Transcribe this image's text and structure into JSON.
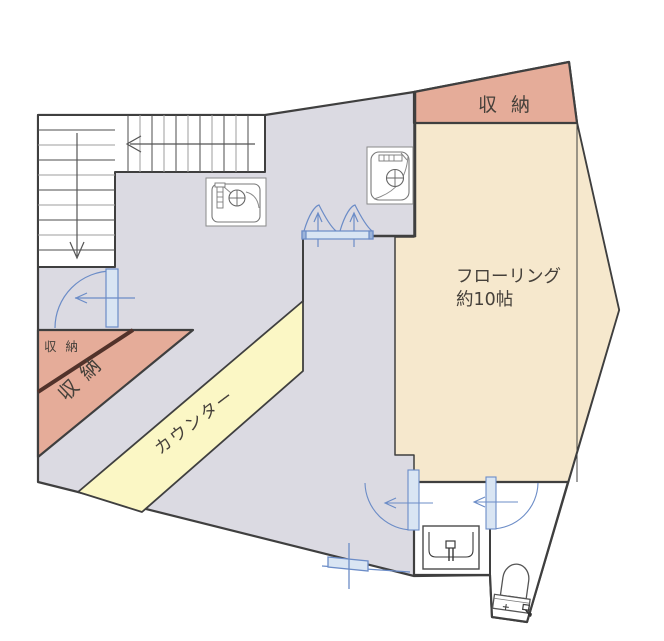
{
  "palette": {
    "floor": "#dbdae2",
    "room": "#f6e8cd",
    "storage": "#e5ac99",
    "counter": "#fbf7c5",
    "door_stroke": "#6b8cc7",
    "door_fill": "#d9e5f3",
    "wall": "#3f3f3f",
    "divider": "#52322a"
  },
  "rooms": {
    "flooring": {
      "name": "フローリング",
      "size": "約10帖"
    },
    "storage_top": {
      "label": "収納"
    },
    "storage_under_stair": {
      "label": "収納"
    },
    "storage_left": {
      "label": "収納"
    },
    "counter": {
      "label": "カウンター"
    }
  }
}
